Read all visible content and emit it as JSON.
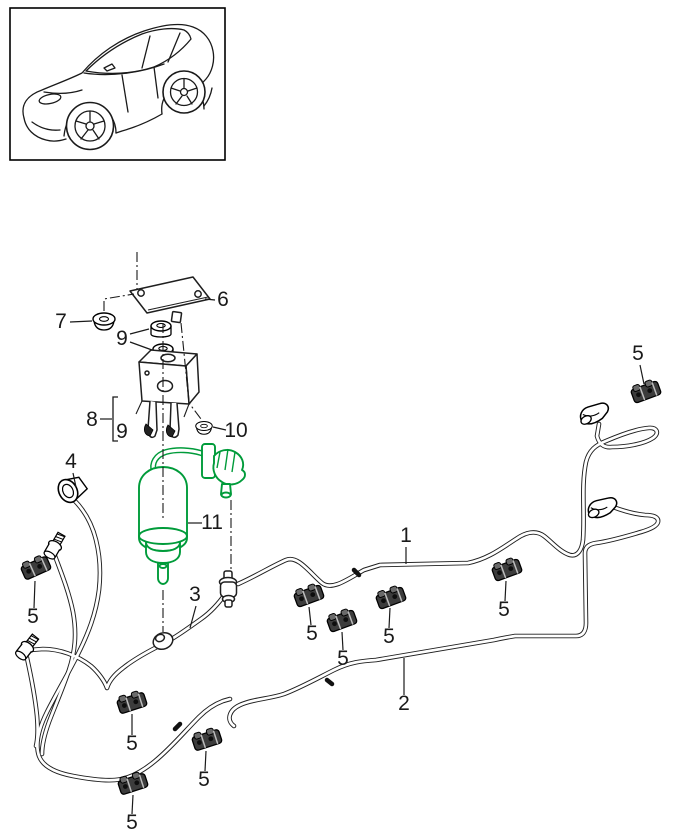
{
  "diagram": {
    "kind": "vehicle-parts-exploded-diagram",
    "highlight_color": "#009b3a",
    "ink_color": "#1a1a1a",
    "callouts": [
      {
        "label": "1",
        "x": 406,
        "y": 542
      },
      {
        "label": "2",
        "x": 404,
        "y": 710
      },
      {
        "label": "3",
        "x": 195,
        "y": 601
      },
      {
        "label": "4",
        "x": 71,
        "y": 468
      },
      {
        "label": "5",
        "x": 638,
        "y": 360
      },
      {
        "label": "5",
        "x": 504,
        "y": 616
      },
      {
        "label": "5",
        "x": 389,
        "y": 643
      },
      {
        "label": "5",
        "x": 343,
        "y": 665
      },
      {
        "label": "5",
        "x": 312,
        "y": 640
      },
      {
        "label": "5",
        "x": 33,
        "y": 623
      },
      {
        "label": "5",
        "x": 132,
        "y": 750
      },
      {
        "label": "5",
        "x": 204,
        "y": 786
      },
      {
        "label": "5",
        "x": 132,
        "y": 829
      },
      {
        "label": "6",
        "x": 223,
        "y": 306
      },
      {
        "label": "7",
        "x": 61,
        "y": 328
      },
      {
        "label": "8",
        "x": 92,
        "y": 426
      },
      {
        "label": "9",
        "x": 122,
        "y": 345
      },
      {
        "label": "9",
        "x": 122,
        "y": 438
      },
      {
        "label": "10",
        "x": 236,
        "y": 437
      },
      {
        "label": "11",
        "x": 212,
        "y": 529
      }
    ]
  }
}
